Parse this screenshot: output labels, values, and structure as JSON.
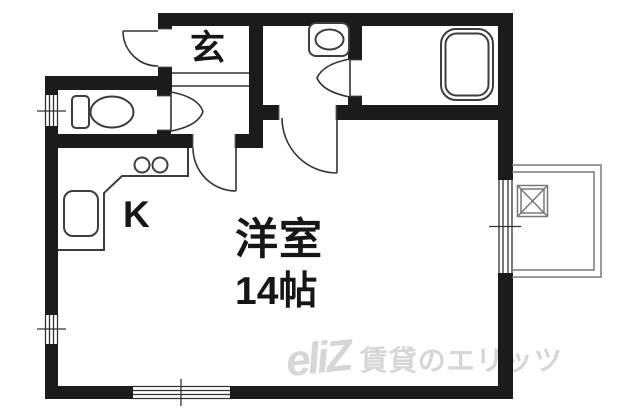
{
  "floorplan": {
    "labels": {
      "entrance": "玄",
      "kitchen": "K",
      "room_name": "洋室",
      "room_size": "14帖"
    },
    "watermark": {
      "logo": "eliZ",
      "text": "賃貸のエリッツ"
    },
    "fixtures": [
      "toilet-icon",
      "kitchen-sink-icon",
      "stove-burners-icon",
      "washbasin-icon",
      "bathtub-icon",
      "washer-pan-icon"
    ],
    "symbols": [
      "entrance-door-arc",
      "toilet-door-wedge",
      "hall-door-arc",
      "washroom-door-arc",
      "bath-door-wedge",
      "window-marks"
    ],
    "colors": {
      "wall": "#1b1b1b",
      "line": "#333333",
      "fixture": "#3d3d3d",
      "balcony": "#787878",
      "text": "#161616",
      "watermark": "#d6d6d6"
    }
  }
}
